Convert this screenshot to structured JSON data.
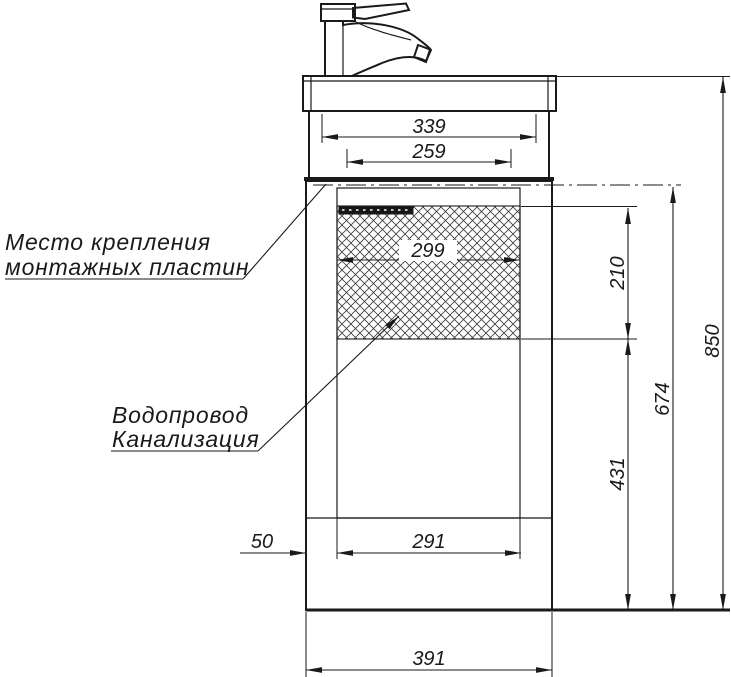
{
  "drawing": {
    "title": "vanity-unit-installation-dimensions",
    "colors": {
      "background": "#ffffff",
      "line": "#1a1a1a"
    },
    "annotations": {
      "mounting": {
        "line1": "Место крепления",
        "line2": "монтажных пластин"
      },
      "plumbing": {
        "line1": "Водопровод",
        "line2": "Канализация"
      }
    },
    "dimensions": {
      "basin_width": "339",
      "basin_inner_width": "259",
      "service_opening_width": "299",
      "plate_zone_height": "210",
      "axis_to_floor_height": "674",
      "total_height": "850",
      "lower_zone_height": "431",
      "side_offset": "50",
      "service_zone_width": "291",
      "cabinet_width": "391"
    }
  }
}
